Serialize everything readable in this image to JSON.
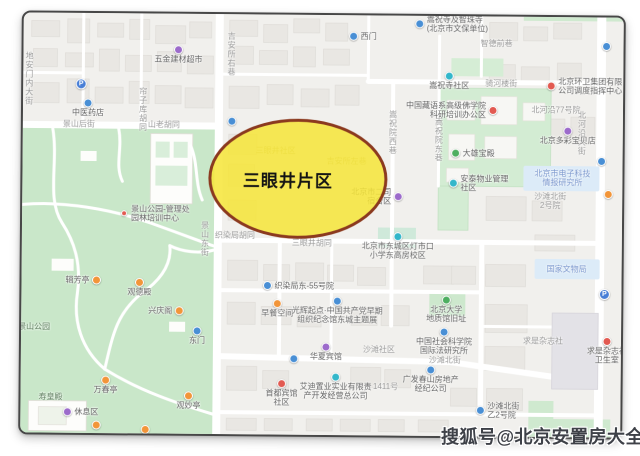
{
  "watermark": {
    "text": "搜狐号@北京安置房大全"
  },
  "highlight": {
    "label": "三眼井片区",
    "fill": "rgba(246,229,59,0.85)",
    "border": "#8a3a20"
  },
  "colors": {
    "map_bg": "#f1f0ed",
    "building": "#e9e7e3",
    "road": "#ffffff",
    "park_green": "#c9e7c9",
    "compound_green": "#d3ecd3",
    "highlight_blue": "#dcebf8",
    "frame_border": "#474747",
    "watermark_text": "#3e4148"
  },
  "icon_colors": {
    "purple": "#9b6bc9",
    "blue": "#4a8fd3",
    "teal": "#35b6c9",
    "green": "#4fae62",
    "orange": "#f0953b",
    "red": "#e05b52",
    "pin": "#4a7fd4"
  },
  "map": {
    "pois": [
      {
        "x": 155,
        "y": 36,
        "icon": "purple",
        "lines": [
          "五金建材超市"
        ],
        "pos": "below"
      },
      {
        "x": 58,
        "y": 71,
        "icon": "pin",
        "lines": [],
        "pos": "below"
      },
      {
        "x": 65,
        "y": 90,
        "icon": "blue",
        "lines": [
          "中医药店"
        ],
        "pos": "below"
      },
      {
        "x": 209,
        "y": 107,
        "icon": "blue",
        "lines": [],
        "pos": "below"
      },
      {
        "x": 330,
        "y": 21,
        "icon": "blue",
        "lines": [
          "西门"
        ],
        "pos": "right"
      },
      {
        "x": 396,
        "y": 8,
        "icon": "blue",
        "lines": [
          "嵩祝寺及智珠寺",
          "(北京市文保单位)"
        ],
        "pos": "right"
      },
      {
        "x": 426,
        "y": 60,
        "icon": "teal",
        "lines": [
          "嵩祝寺社区"
        ],
        "pos": "below"
      },
      {
        "x": 528,
        "y": 69,
        "icon": "red",
        "lines": [
          "北京环卫集团有限",
          "公司调度指挥中心"
        ],
        "pos": "right"
      },
      {
        "x": 470,
        "y": 94,
        "icon": "red",
        "lines": [
          "中国藏语系高级佛学院",
          "科研培训办公区"
        ],
        "pos": "left"
      },
      {
        "x": 433,
        "y": 137,
        "icon": "green",
        "lines": [
          "大雄宝殿"
        ],
        "pos": "right"
      },
      {
        "x": 431,
        "y": 167,
        "icon": "teal",
        "lines": [
          "安泰物业管理",
          "社区"
        ],
        "pos": "right"
      },
      {
        "x": 376,
        "y": 181,
        "icon": "purple",
        "lines": [
          "北京市二司",
          "宿舍区"
        ],
        "pos": "left"
      },
      {
        "x": 545,
        "y": 114,
        "icon": "purple",
        "lines": [
          "北京多彩宝贝店"
        ],
        "pos": "below"
      },
      {
        "x": 579,
        "y": 144,
        "icon": "blue",
        "lines": [],
        "pos": "right"
      },
      {
        "x": 586,
        "y": 177,
        "icon": "orange",
        "lines": [],
        "pos": "right"
      },
      {
        "x": 583,
        "y": 277,
        "icon": "pin",
        "lines": [],
        "pos": "below"
      },
      {
        "x": 586,
        "y": 324,
        "icon": "red",
        "lines": [
          "求是杂志社",
          "卫生室"
        ],
        "pos": "below"
      },
      {
        "x": 460,
        "y": 394,
        "icon": "blue",
        "lines": [
          "沙滩北街",
          "乙2号院"
        ],
        "pos": "right"
      },
      {
        "x": 315,
        "y": 362,
        "icon": "teal",
        "lines": [
          "艾迪置业实业有限责",
          "产开发经营总公司"
        ],
        "pos": "below"
      },
      {
        "x": 410,
        "y": 354,
        "icon": "blue",
        "lines": [
          "广发春山房地产",
          "经纪公司"
        ],
        "pos": "below"
      },
      {
        "x": 273,
        "y": 344,
        "icon": "blue",
        "lines": [],
        "pos": "below"
      },
      {
        "x": 305,
        "y": 332,
        "icon": "purple",
        "lines": [
          "华夏宾馆"
        ],
        "pos": "below"
      },
      {
        "x": 261,
        "y": 369,
        "icon": "red",
        "lines": [
          "首都宾馆",
          "社区"
        ],
        "pos": "below"
      },
      {
        "x": 246,
        "y": 271,
        "icon": "blue",
        "lines": [
          "织染局东-55号院"
        ],
        "pos": "right"
      },
      {
        "x": 256,
        "y": 289,
        "icon": "orange",
        "lines": [
          "早餐空间"
        ],
        "pos": "below"
      },
      {
        "x": 316,
        "y": 286,
        "icon": "blue",
        "lines": [
          "光辉起点·中国共产党早期",
          "组织纪念馆东城主题展"
        ],
        "pos": "below"
      },
      {
        "x": 376,
        "y": 221,
        "icon": "teal",
        "lines": [
          "北京市东城区灯市口",
          "小学东高房校区"
        ],
        "pos": "below"
      },
      {
        "x": 425,
        "y": 284,
        "icon": "green",
        "lines": [
          "北京大学",
          "地质馆旧址"
        ],
        "pos": "below"
      },
      {
        "x": 423,
        "y": 316,
        "icon": "blue",
        "lines": [
          "中国社会科学院",
          "国际法研究所"
        ],
        "pos": "below"
      },
      {
        "x": 75,
        "y": 267,
        "icon": "orange",
        "lines": [
          "辑芳亭"
        ],
        "pos": "left"
      },
      {
        "x": 118,
        "y": 269,
        "icon": "orange",
        "lines": [
          "观德殿"
        ],
        "pos": "below"
      },
      {
        "x": 158,
        "y": 297,
        "icon": "orange",
        "lines": [
          "兴庆阁"
        ],
        "pos": "left"
      },
      {
        "x": 176,
        "y": 317,
        "icon": "blue",
        "lines": [
          "东门"
        ],
        "pos": "below"
      },
      {
        "x": 85,
        "y": 367,
        "icon": "orange",
        "lines": [
          "万春亭"
        ],
        "pos": "below"
      },
      {
        "x": 168,
        "y": 382,
        "icon": "orange",
        "lines": [
          "观妙亭"
        ],
        "pos": "below"
      },
      {
        "x": 47,
        "y": 399,
        "icon": "purple",
        "lines": [
          "休息区"
        ],
        "pos": "right"
      },
      {
        "x": 76,
        "y": 412,
        "icon": "orange",
        "lines": [],
        "pos": "below"
      },
      {
        "x": 125,
        "y": 416,
        "icon": "orange",
        "lines": [],
        "pos": "below"
      },
      {
        "x": 102,
        "y": 200,
        "icon": "red",
        "small": true,
        "lines": [
          "景山公园-管理处",
          "园林培训中心"
        ],
        "pos": "right"
      },
      {
        "x": 583,
        "y": 29,
        "icon": "blue",
        "lines": [],
        "pos": "below"
      }
    ],
    "labels": [
      {
        "x": 6,
        "y": 66,
        "lines": [
          "地安门内大街"
        ],
        "vertical": true
      },
      {
        "x": 120,
        "y": 96,
        "lines": [
          "帘子库胡同"
        ],
        "vertical": true
      },
      {
        "x": 56,
        "y": 111,
        "lines": [
          "景山后街"
        ]
      },
      {
        "x": 141,
        "y": 111,
        "lines": [
          "山老胡同"
        ]
      },
      {
        "x": 208,
        "y": 40,
        "lines": [
          "吉安所右巷"
        ],
        "vertical": true
      },
      {
        "x": 473,
        "y": 27,
        "lines": [
          "智德前巷"
        ]
      },
      {
        "x": 478,
        "y": 67,
        "lines": [
          "骑河楼街"
        ]
      },
      {
        "x": 533,
        "y": 93,
        "lines": [
          "北河沿77号院"
        ]
      },
      {
        "x": 370,
        "y": 117,
        "lines": [
          "嵩祝院西巷"
        ],
        "vertical": true
      },
      {
        "x": 416,
        "y": 124,
        "lines": [
          "嵩祝院东巷"
        ],
        "vertical": true
      },
      {
        "x": 559,
        "y": 116,
        "lines": [
          "北河沿大街"
        ],
        "vertical": true
      },
      {
        "x": 545,
        "y": 252,
        "lines": [
          "国家文物局"
        ],
        "tone": "blue"
      },
      {
        "x": 540,
        "y": 161,
        "lines": [
          "北京市电子科技",
          "情报研究所"
        ],
        "tone": "blue"
      },
      {
        "x": 528,
        "y": 184,
        "lines": [
          "沙滩北街",
          "2号院"
        ]
      },
      {
        "x": 522,
        "y": 324,
        "lines": [
          "求是杂志社"
        ]
      },
      {
        "x": 183,
        "y": 225,
        "lines": [
          "景山东街"
        ],
        "vertical": true
      },
      {
        "x": 213,
        "y": 221,
        "lines": [
          "织染局胡同"
        ]
      },
      {
        "x": 290,
        "y": 228,
        "lines": [
          "三眼井胡同"
        ]
      },
      {
        "x": 424,
        "y": 344,
        "lines": [
          "沙滩北街"
        ]
      },
      {
        "x": 358,
        "y": 334,
        "lines": [
          "沙滩社区"
        ]
      },
      {
        "x": 365,
        "y": 371,
        "lines": [
          "1411号"
        ]
      },
      {
        "x": 13,
        "y": 314,
        "lines": [
          "景山公园"
        ],
        "tone": "park"
      },
      {
        "x": 30,
        "y": 384,
        "lines": [
          "寿皇殿"
        ],
        "tone": "park"
      },
      {
        "x": 253,
        "y": 136,
        "lines": [
          "三眼井社区"
        ],
        "tone": "faint"
      },
      {
        "x": 324,
        "y": 146,
        "lines": [
          "吉安所左巷"
        ],
        "tone": "faint"
      }
    ]
  }
}
